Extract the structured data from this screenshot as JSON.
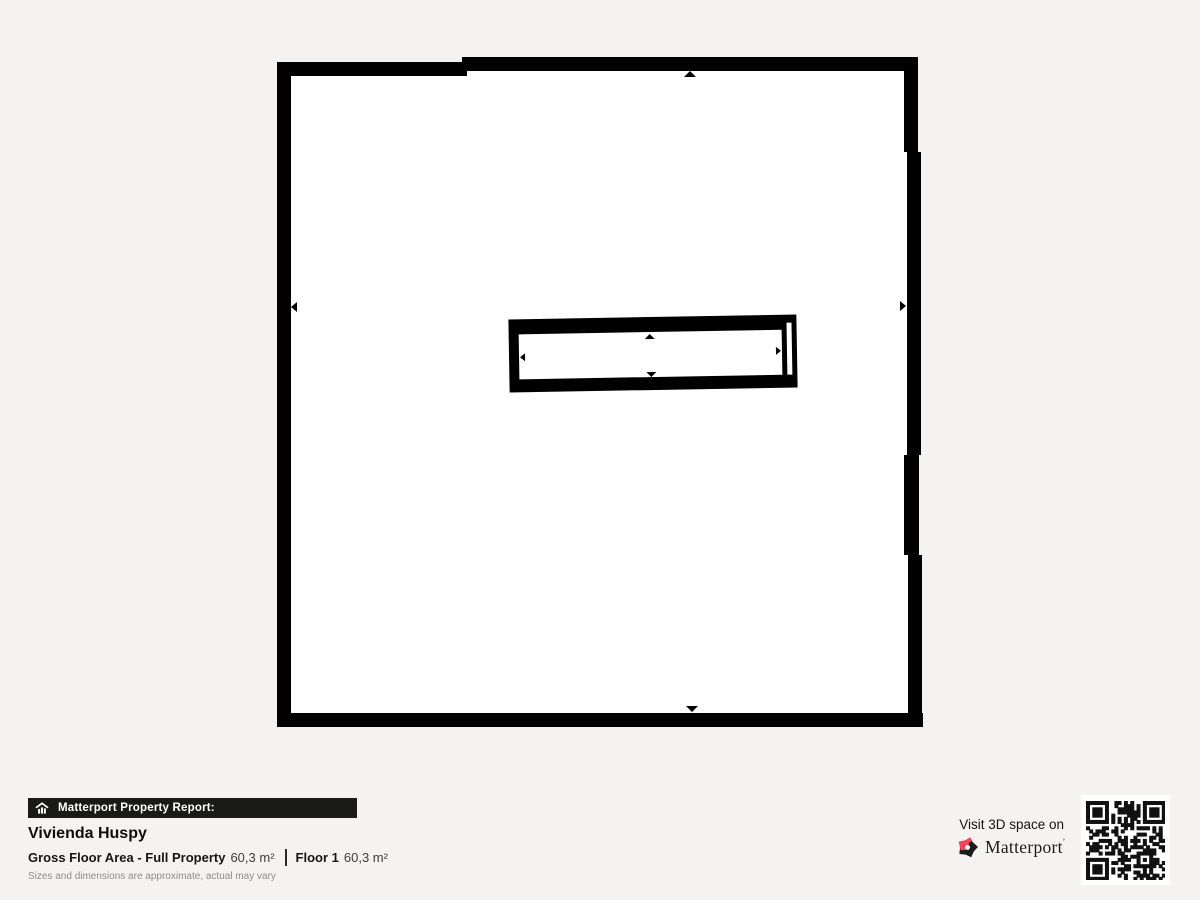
{
  "page": {
    "background_color": "#f4f3f1"
  },
  "floor_plan": {
    "wall_color": "#000000",
    "room_color": "#ffffff",
    "marker_icons": [
      "arrow-up",
      "arrow-down",
      "arrow-left",
      "arrow-right"
    ]
  },
  "report": {
    "banner_label": "Matterport Property Report:",
    "property_name": "Vivienda Huspy",
    "area_label": "Gross Floor Area - Full Property",
    "area_value": "60,3 m²",
    "floor_label": "Floor 1",
    "floor_value": "60,3 m²",
    "disclaimer": "Sizes and dimensions are approximate, actual may vary"
  },
  "footer": {
    "visit_text": "Visit 3D space on",
    "brand_name": "Matterport",
    "brand_trademark": "’",
    "brand_accent_color": "#f4435a"
  }
}
